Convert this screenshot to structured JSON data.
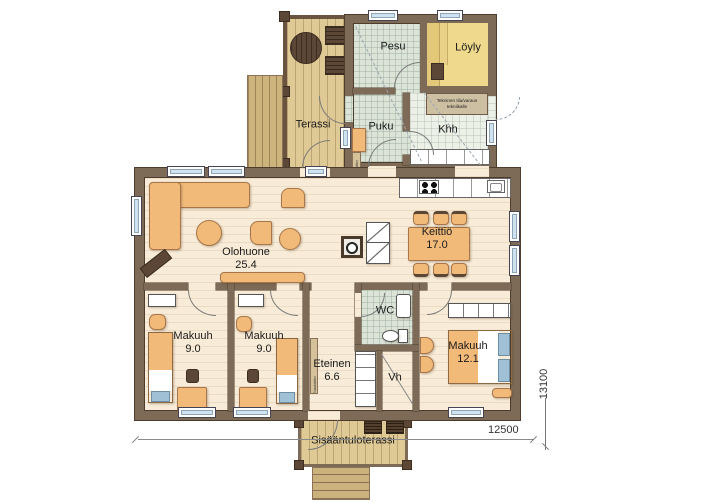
{
  "rooms": {
    "pesu": {
      "label": "Pesu"
    },
    "loyly": {
      "label": "Löyly"
    },
    "terassi": {
      "label": "Terassi"
    },
    "puku": {
      "label": "Puku"
    },
    "khh": {
      "label": "Khh"
    },
    "olohuone": {
      "label": "Olohuone",
      "area": "25.4"
    },
    "keittio": {
      "label": "Keittiö",
      "area": "17.0"
    },
    "makuuhuone1": {
      "label": "Makuuh",
      "area": "9.0"
    },
    "makuuhuone2": {
      "label": "Makuuh",
      "area": "9.0"
    },
    "eteinen": {
      "label": "Eteinen",
      "area": "6.6"
    },
    "wc": {
      "label": "WC"
    },
    "vh": {
      "label": "Vh"
    },
    "makuuhuone3": {
      "label": "Makuuh",
      "area": "12.1"
    },
    "sisaantuloterassi": {
      "label": "Sisääntuloterassi"
    }
  },
  "annotations": {
    "tech_note_line1": "Tekninen tila/varaus",
    "tech_note_line2": "tekniikalle",
    "coat_rack_label": "Naulakko"
  },
  "dimensions": {
    "width_label": "12500",
    "height_label": "13100"
  },
  "colors": {
    "wall": "#7d6b57",
    "floor": "#f8ecd8",
    "deck": "#dfc994",
    "tile": "#dce4d8",
    "sauna_floor": "#efd98c",
    "furniture": "#f1ba79",
    "window_pane": "#cfe2f0",
    "dark_wood": "#5c4736",
    "bed_blue": "#9fc0d5"
  }
}
